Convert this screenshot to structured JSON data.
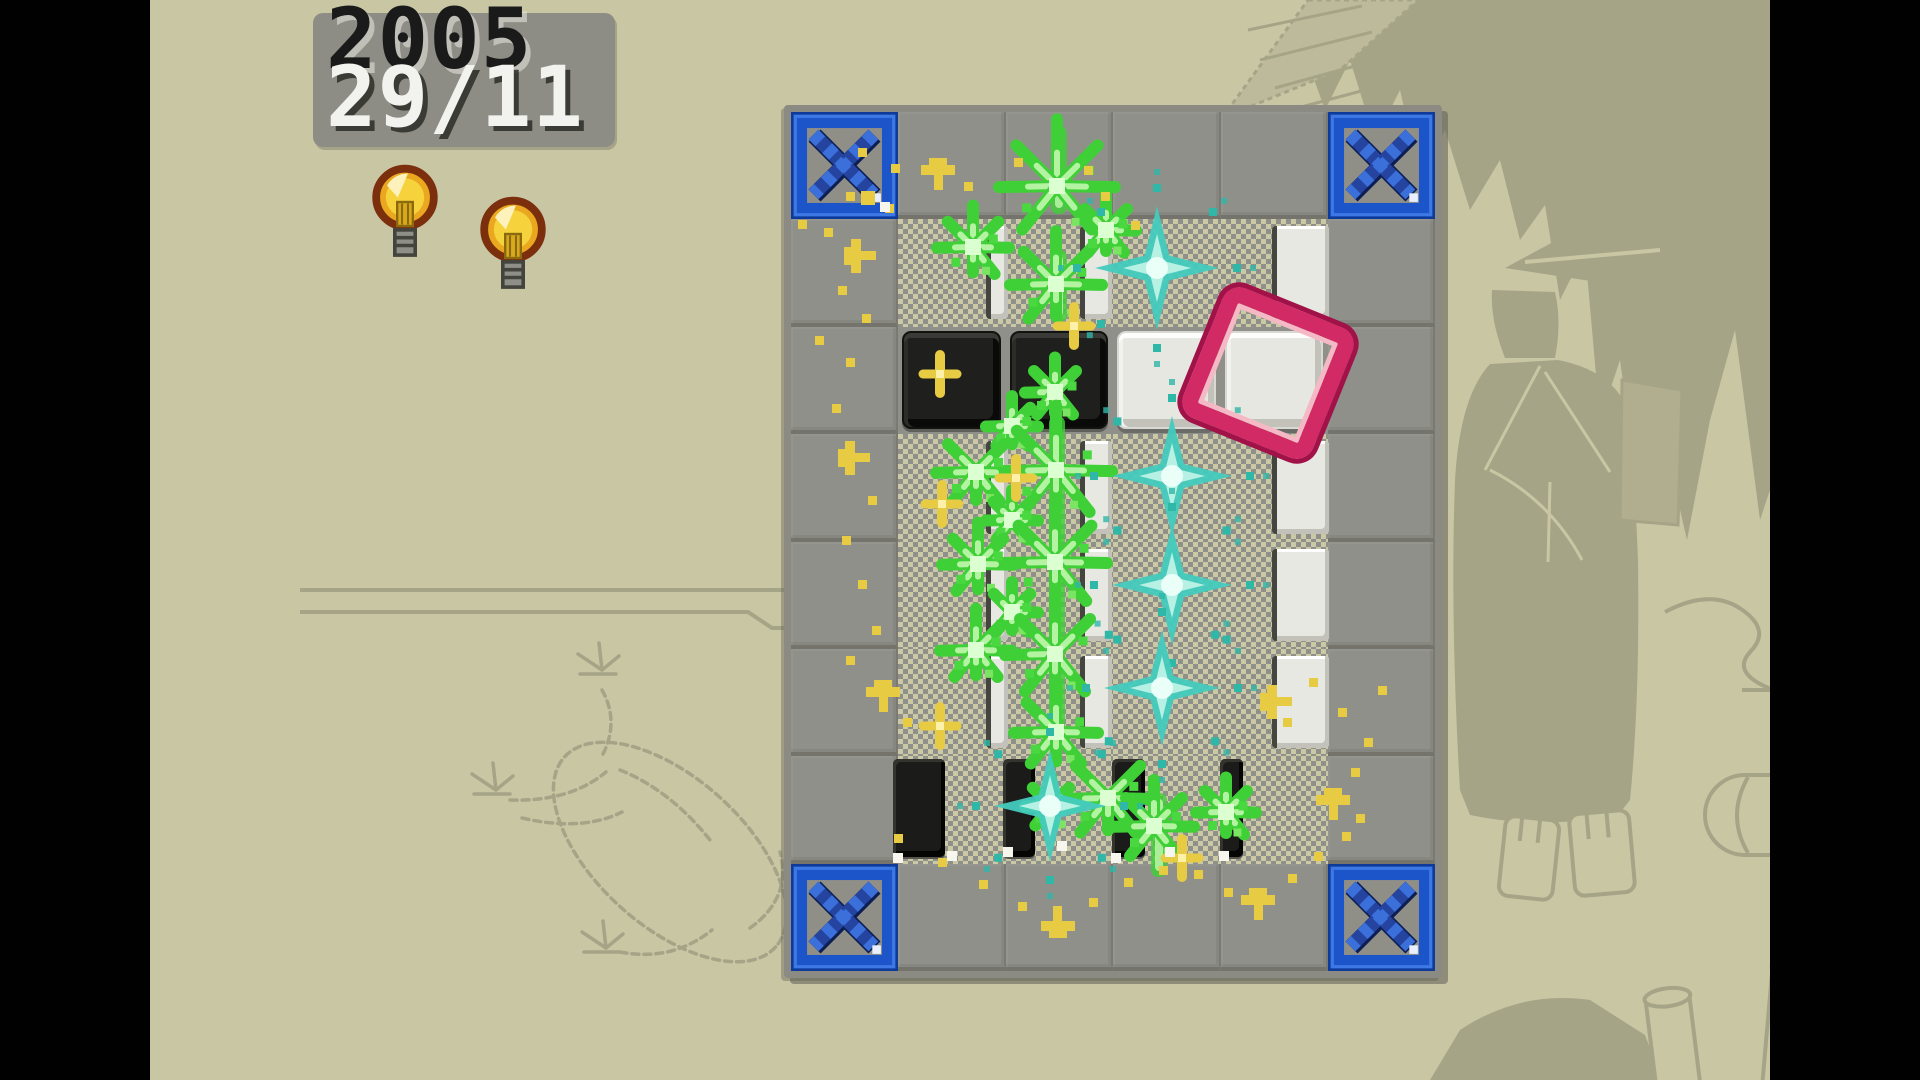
{
  "hud": {
    "score": "2005",
    "date": "29/11",
    "hint_bulbs": 2,
    "bulb_positions": [
      [
        222,
        164
      ],
      [
        330,
        196
      ]
    ]
  },
  "palette": {
    "bg": "#c9c6a4",
    "art": "#a6a487",
    "artLight": "#bdba9c",
    "gray": "#90908a",
    "dith": "#cbc8a6",
    "panel": "#8d8d85",
    "inkDark": "#1a1a1a",
    "inkLight": "#f2f2ee",
    "blueFrame": "#1b55c9",
    "blueX": "#24449f",
    "blueXlight": "#3b6fd9",
    "green": "#3fd037",
    "greenLight": "#b4f3a2",
    "cyan": "#43cbbd",
    "cyanDark": "#2fb7a8",
    "cyanLight": "#eafff8",
    "yellow": "#e7cb42",
    "pink": "#d12a64",
    "pinkLight": "#f4b9c4"
  },
  "board": {
    "grid": {
      "cols": 6,
      "rows": 8,
      "left": 641,
      "top": 112,
      "cell": 107.4
    },
    "corner_cells": [
      [
        0,
        0
      ],
      [
        5,
        0
      ],
      [
        0,
        7
      ],
      [
        5,
        7
      ]
    ],
    "interior": {
      "col_min": 1,
      "col_max": 4,
      "row_min": 1,
      "row_max": 6
    },
    "solid_rows": [
      2
    ],
    "black_tiles": [
      [
        1,
        2
      ],
      [
        2,
        2
      ]
    ],
    "white_tiles": [
      [
        3,
        2
      ],
      [
        4,
        2
      ]
    ],
    "white_slivers": {
      "rows": [
        1,
        3,
        4,
        5
      ],
      "cols": [
        {
          "col": 1,
          "x": 836,
          "w": 17
        },
        {
          "col": 2,
          "x": 930,
          "w": 27
        },
        {
          "col": 4,
          "x": 1122,
          "w": 52
        }
      ]
    },
    "black_slivers": [
      {
        "x": 743,
        "w": 52
      },
      {
        "x": 853,
        "w": 32
      },
      {
        "x": 962,
        "w": 33
      },
      {
        "x": 1070,
        "w": 23
      }
    ],
    "cursor": {
      "col": 4,
      "row": 2,
      "angle": 22
    }
  },
  "effects": {
    "green_bars": [
      [
        901,
        126,
        16,
        88
      ],
      [
        901,
        250,
        16,
        72
      ],
      [
        899,
        416,
        16,
        322
      ],
      [
        1001,
        793,
        16,
        84
      ]
    ],
    "green_bursts": [
      [
        907,
        186,
        58
      ],
      [
        823,
        247,
        36
      ],
      [
        906,
        284,
        46
      ],
      [
        956,
        230,
        30
      ],
      [
        905,
        392,
        30
      ],
      [
        862,
        426,
        26
      ],
      [
        906,
        470,
        56
      ],
      [
        826,
        472,
        40
      ],
      [
        862,
        520,
        26
      ],
      [
        905,
        562,
        52
      ],
      [
        828,
        564,
        36
      ],
      [
        862,
        612,
        26
      ],
      [
        905,
        654,
        50
      ],
      [
        826,
        650,
        36
      ],
      [
        906,
        732,
        42
      ],
      [
        958,
        798,
        46
      ],
      [
        1004,
        826,
        40
      ],
      [
        1076,
        812,
        30
      ],
      [
        901,
        806,
        26
      ]
    ],
    "cyan_bursts": [
      [
        1007,
        268,
        62
      ],
      [
        1022,
        476,
        60
      ],
      [
        1022,
        585,
        60
      ],
      [
        1012,
        688,
        58
      ],
      [
        900,
        806,
        56
      ]
    ],
    "yellow_sparks": [
      [
        790,
        374
      ],
      [
        792,
        504
      ],
      [
        790,
        726
      ],
      [
        866,
        478
      ],
      [
        924,
        326
      ],
      [
        1032,
        858
      ]
    ],
    "yellow_particles": [
      [
        712,
        152,
        "d"
      ],
      [
        745,
        168,
        "d"
      ],
      [
        788,
        170,
        "m"
      ],
      [
        818,
        186,
        "d"
      ],
      [
        700,
        196,
        "d"
      ],
      [
        739,
        208,
        "d"
      ],
      [
        652,
        224,
        "d"
      ],
      [
        678,
        232,
        "d"
      ],
      [
        706,
        256,
        "l"
      ],
      [
        692,
        290,
        "d"
      ],
      [
        716,
        318,
        "d"
      ],
      [
        669,
        340,
        "d"
      ],
      [
        700,
        362,
        "d"
      ],
      [
        686,
        408,
        "d"
      ],
      [
        700,
        458,
        "l"
      ],
      [
        722,
        500,
        "d"
      ],
      [
        696,
        540,
        "d"
      ],
      [
        712,
        584,
        "d"
      ],
      [
        726,
        630,
        "d"
      ],
      [
        700,
        660,
        "d"
      ],
      [
        733,
        692,
        "m"
      ],
      [
        757,
        722,
        "d"
      ],
      [
        718,
        198,
        "D"
      ],
      [
        868,
        162,
        "d"
      ],
      [
        938,
        170,
        "d"
      ],
      [
        955,
        196,
        "d"
      ],
      [
        985,
        225,
        "d"
      ],
      [
        748,
        838,
        "d"
      ],
      [
        792,
        862,
        "d"
      ],
      [
        833,
        884,
        "d"
      ],
      [
        872,
        906,
        "d"
      ],
      [
        908,
        926,
        "v"
      ],
      [
        943,
        902,
        "d"
      ],
      [
        978,
        882,
        "d"
      ],
      [
        1013,
        870,
        "d"
      ],
      [
        1048,
        874,
        "d"
      ],
      [
        1078,
        892,
        "d"
      ],
      [
        1108,
        900,
        "m"
      ],
      [
        1142,
        878,
        "d"
      ],
      [
        1168,
        856,
        "d"
      ],
      [
        1196,
        836,
        "d"
      ],
      [
        1183,
        800,
        "m"
      ],
      [
        1205,
        772,
        "d"
      ],
      [
        1218,
        742,
        "d"
      ],
      [
        1192,
        712,
        "d"
      ],
      [
        1232,
        690,
        "d"
      ],
      [
        1163,
        682,
        "d"
      ],
      [
        1122,
        702,
        "l"
      ],
      [
        1137,
        722,
        "d"
      ],
      [
        1210,
        818,
        "d"
      ]
    ],
    "white_sparks": [
      [
        735,
        207
      ],
      [
        748,
        858
      ],
      [
        802,
        856
      ],
      [
        858,
        852
      ],
      [
        912,
        846
      ],
      [
        966,
        858
      ],
      [
        1020,
        852
      ],
      [
        1074,
        856
      ]
    ]
  }
}
